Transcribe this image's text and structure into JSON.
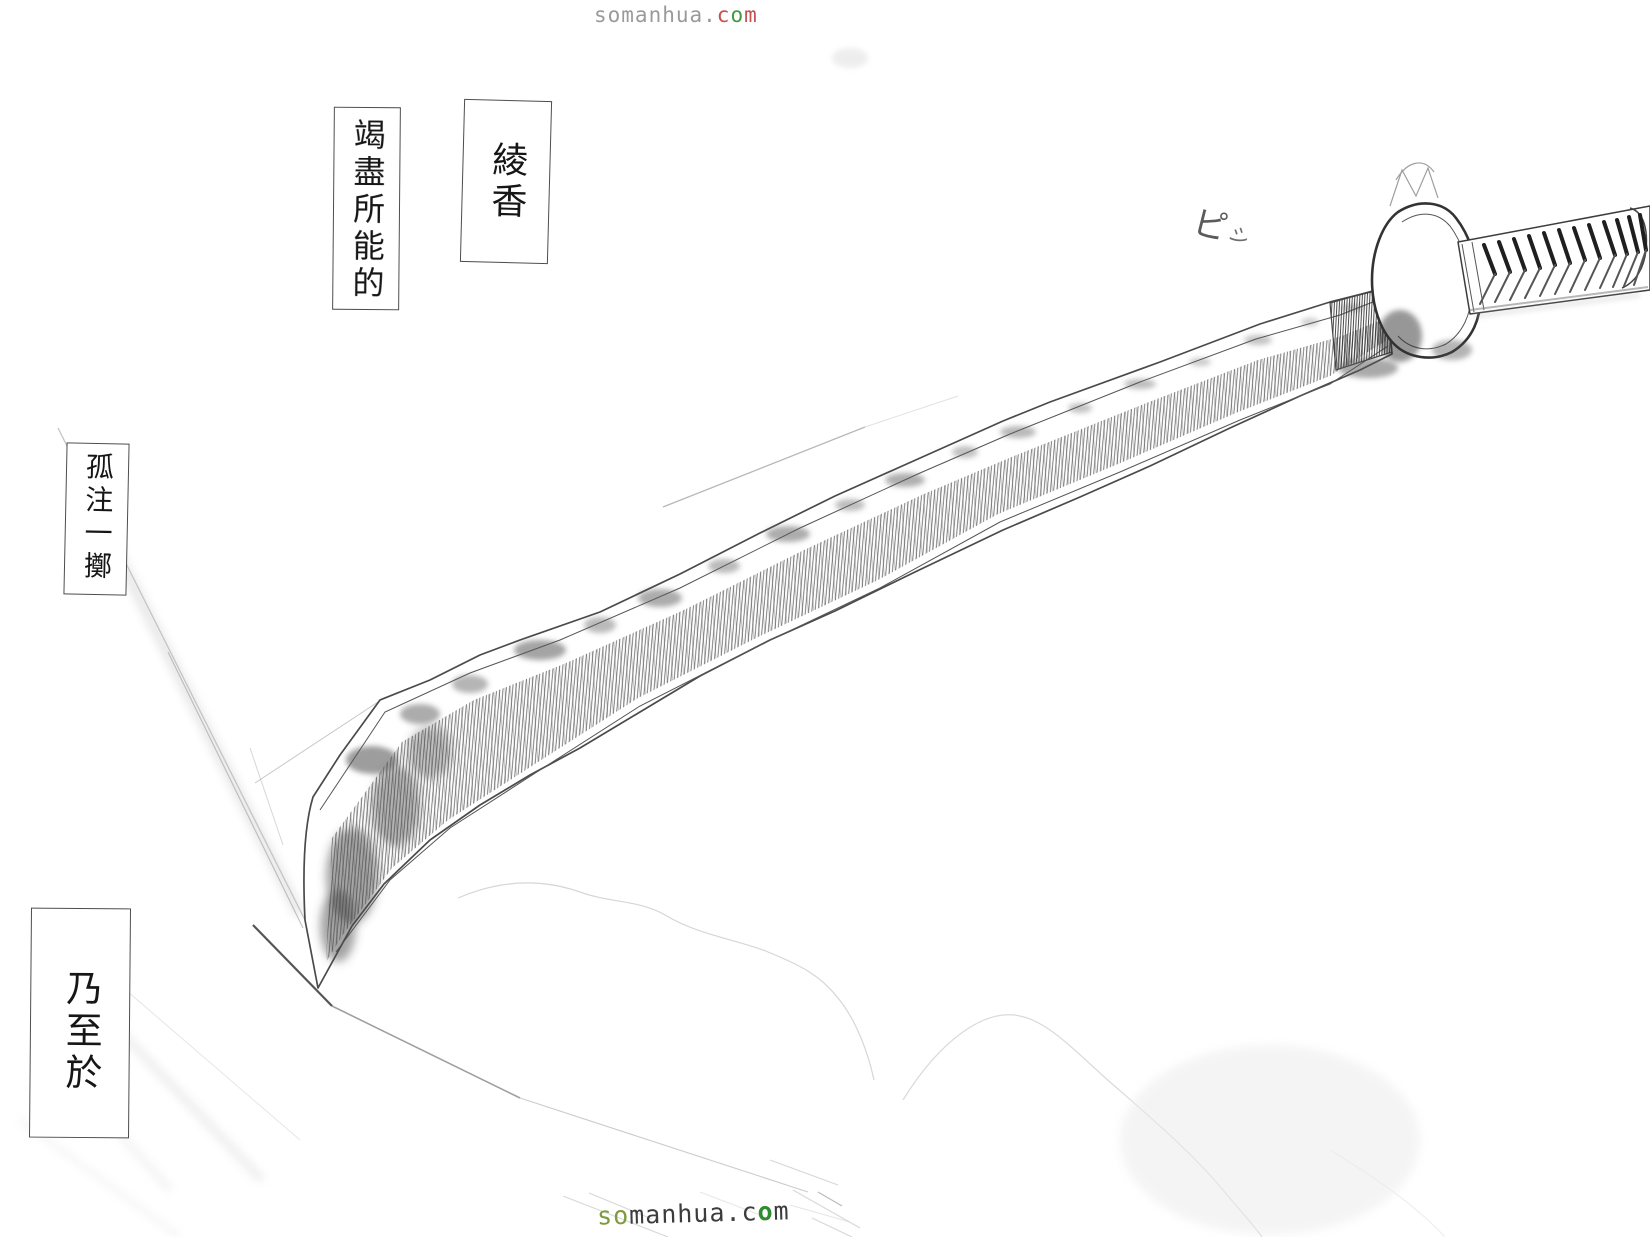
{
  "page": {
    "background_color": "#ffffff",
    "ink_color": "#3d3d3d"
  },
  "watermark_top": {
    "text": "somanhua.com",
    "segments": [
      {
        "text": "somanhua.",
        "color": "#9a9a9a"
      },
      {
        "text": "c",
        "color": "#c45050"
      },
      {
        "text": "o",
        "color": "#3f9a3f"
      },
      {
        "text": "m",
        "color": "#c45050"
      }
    ]
  },
  "watermark_bottom": {
    "text": "somanhua.com",
    "segments": [
      {
        "text": "so",
        "color": "#7f9a3f"
      },
      {
        "text": "manhua",
        "color": "#3c3c3c"
      },
      {
        "text": ".c",
        "color": "#3c3c3c"
      },
      {
        "text": "o",
        "color": "#2e8b2e",
        "bold": true
      },
      {
        "text": "m",
        "color": "#3c3c3c"
      }
    ]
  },
  "speech_boxes": [
    {
      "id": "ayaka",
      "text": "綾香"
    },
    {
      "id": "exert",
      "text": "竭盡所能的"
    },
    {
      "id": "gamble",
      "text": "孤注一擲"
    },
    {
      "id": "even",
      "text": "乃至於"
    }
  ],
  "sfx": {
    "text": "ピシ",
    "parts": [
      "ピ",
      "シ"
    ]
  }
}
